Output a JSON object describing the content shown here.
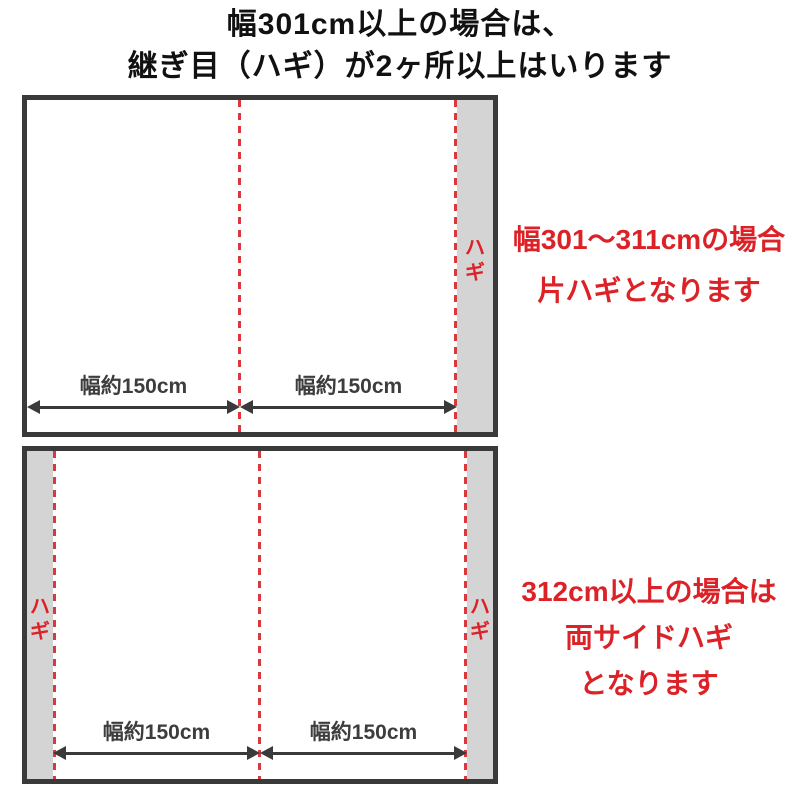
{
  "title": {
    "line1": "幅301cm以上の場合は、",
    "line2": "継ぎ目（ハギ）が2ヶ所以上はいります"
  },
  "panel1": {
    "hagi_label": "ハギ",
    "width_label_left": "幅約150cm",
    "width_label_right": "幅約150cm",
    "note": {
      "line1": "幅301〜311cmの場合",
      "line2": "片ハギとなります"
    }
  },
  "panel2": {
    "hagi_label_left": "ハギ",
    "hagi_label_right": "ハギ",
    "width_label_left": "幅約150cm",
    "width_label_right": "幅約150cm",
    "note": {
      "line1": "312cm以上の場合は",
      "line2": "両サイドハギ",
      "line3": "となります"
    }
  },
  "colors": {
    "accent_red": "#dc2127",
    "dash_red": "#d8393f",
    "border_dark": "#3a3a3a",
    "strip_gray": "#d4d4d4",
    "title_black": "#111111",
    "label_gray": "#3d3d3d"
  }
}
